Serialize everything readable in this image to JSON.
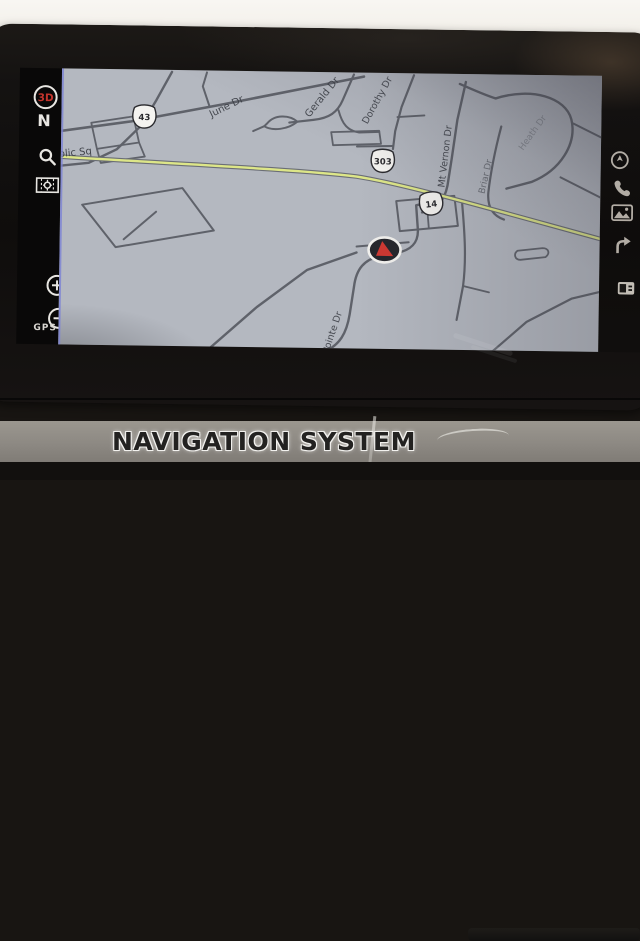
{
  "bottom_bar": {
    "label": "NAVIGATION SYSTEM"
  },
  "left_toolbar": {
    "view_3d_label": "3D",
    "north_label": "N",
    "zoom_in_label": "+",
    "zoom_out_label": "−",
    "gps_label": "GPS"
  },
  "map": {
    "colors": {
      "bg": "#b4b8c0",
      "road": "#5f626a",
      "route": "#dde688",
      "route_casing": "#6b6e76",
      "label": "#3a3d44",
      "shield_fill": "#f4f3f0",
      "shield_stroke": "#2a2a2e",
      "marker_ring": "#f2f1ee",
      "marker_body": "#26262b",
      "marker_arrow": "#cf3832"
    },
    "street_labels": [
      {
        "text": "Public Sq",
        "x": -14,
        "y": 90,
        "rot": -6,
        "size": 10,
        "op": 0.95
      },
      {
        "text": "June Dr",
        "x": 150,
        "y": 47,
        "rot": -27,
        "size": 10,
        "op": 0.9
      },
      {
        "text": "Gerald Dr",
        "x": 248,
        "y": 46,
        "rot": -52,
        "size": 10,
        "op": 0.9
      },
      {
        "text": "Dorothy Dr",
        "x": 306,
        "y": 52,
        "rot": -62,
        "size": 9.5,
        "op": 0.9
      },
      {
        "text": "Mt Vernon Dr",
        "x": 384,
        "y": 114,
        "rot": -84,
        "size": 9.5,
        "op": 0.9
      },
      {
        "text": "Briar Dr",
        "x": 424,
        "y": 120,
        "rot": -78,
        "size": 9,
        "op": 0.6
      },
      {
        "text": "Heath Dr",
        "x": 462,
        "y": 76,
        "rot": -55,
        "size": 9,
        "op": 0.35
      },
      {
        "text": "Pointe Dr",
        "x": 270,
        "y": 282,
        "rot": -72,
        "size": 9.5,
        "op": 0.9
      }
    ],
    "route_shields": [
      {
        "num": "43",
        "x": 83,
        "y": 47,
        "rot": 0
      },
      {
        "num": "303",
        "x": 322,
        "y": 88,
        "rot": 0
      },
      {
        "num": "14",
        "x": 371,
        "y": 130,
        "rot": -8
      }
    ],
    "roads": [
      {
        "d": "M -10,64 L 70,52 L 160,34 L 250,15 L 302,4",
        "w": 2.6
      },
      {
        "d": "M 148,36 L 141,16 L 145,2",
        "w": 2
      },
      {
        "d": "M 110,2 L 95,30 L 80,56 L 56,80 L 28,94 L -6,98",
        "w": 2.4
      },
      {
        "d": "M 30,54 L 72,47 L 78,73 L 36,80 Z",
        "w": 1.8
      },
      {
        "d": "M 36,80 L 40,94 L 84,87 L 78,73",
        "w": 1.8
      },
      {
        "d": "M 292,2 L 281,28 C 276,40 268,46 252,48 L 228,51",
        "w": 2.2
      },
      {
        "d": "M 277,38 C 281,52 286,58 298,60 L 318,59",
        "w": 2
      },
      {
        "d": "M 206,52 C 213,43 228,43 236,50 C 227,58 211,60 203,55 Z",
        "w": 2
      },
      {
        "d": "M 203,55 L 192,60",
        "w": 2
      },
      {
        "d": "M 352,2 L 340,34 L 334,58 L 332,76",
        "w": 2.2
      },
      {
        "d": "M 336,44 L 363,42",
        "w": 1.8
      },
      {
        "d": "M 296,74 L 332,73",
        "w": 2
      },
      {
        "d": "M 270,60 L 318,58 L 320,71 L 272,73 Z",
        "w": 1.8
      },
      {
        "d": "M 404,8 L 396,46 L 391,84 L 387,112 C 384,128 376,136 362,139",
        "w": 2.4
      },
      {
        "d": "M 440,52 C 434,76 430,98 428,118 C 427,132 432,141 444,145",
        "w": 2.2
      },
      {
        "d": "M 398,10 C 412,16 424,21 434,24 C 470,12 504,22 510,44 C 516,68 500,95 471,107 L 446,114",
        "w": 2.4
      },
      {
        "d": "M 512,48 L 545,64",
        "w": 2
      },
      {
        "d": "M 500,102 L 545,124",
        "w": 2
      },
      {
        "d": "M 22,136 L 122,118 L 154,160 L 56,178 Z",
        "w": 2
      },
      {
        "d": "M 64,170 L 96,142",
        "w": 2
      },
      {
        "d": "M 336,128 L 394,122 L 398,152 L 340,158 Z",
        "w": 2
      },
      {
        "d": "M 366,124 L 369,155",
        "w": 1.8
      },
      {
        "d": "M 372,128 L 356,132 L 358,156 C 359,170 351,177 337,180 L 321,183 C 305,187 297,196 295,214 L 291,242 C 288,262 281,272 268,279",
        "w": 2.4
      },
      {
        "d": "M 297,174 L 349,169",
        "w": 2
      },
      {
        "d": "M 150,279 L 198,236 L 248,198 L 297,180",
        "w": 2.4
      },
      {
        "d": "M 402,130 C 405,160 407,186 404,212 L 398,246",
        "w": 2.2
      },
      {
        "d": "M 404,212 L 430,218",
        "w": 1.8
      },
      {
        "d": "M 458,176 L 483,173 C 489,173 491,178 486,182 L 461,185 C 455,185 454,179 458,176 Z",
        "w": 1.8
      },
      {
        "d": "M 432,279 L 468,247 L 513,223 L 545,215",
        "w": 2.2
      }
    ],
    "route_path": "M -6,88 C 120,94 240,98 296,104 C 345,111 432,135 548,165",
    "vehicle_marker": {
      "x": 325,
      "y": 177
    }
  }
}
